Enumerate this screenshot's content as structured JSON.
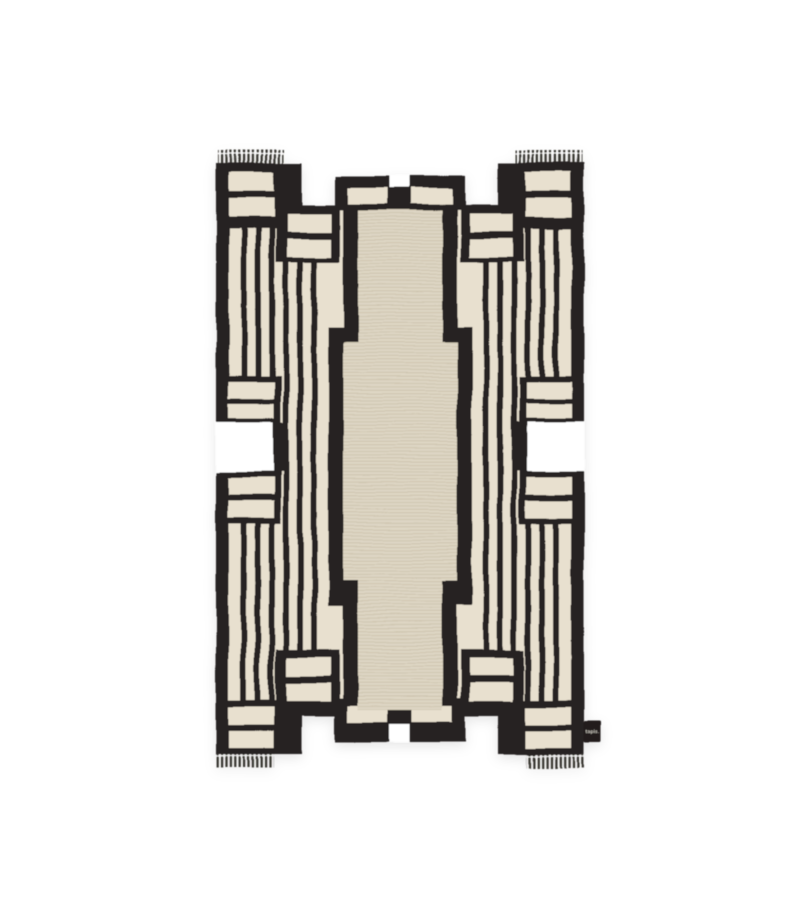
{
  "meta": {
    "description": "Product photograph of a hand-knotted black and cream art-deco geometric rug with stepped silhouette and fringed ends, centered on a plain white background",
    "alt": "Black and cream geometric art deco rug with fringe"
  },
  "colors": {
    "background": "#ffffff",
    "black": "#282320",
    "cream": "#e8e0cf",
    "field": "#ded6c4",
    "field_line": "#c3b8a1",
    "fringe": "#33302c",
    "tag": "#221f1c",
    "tag_text": "#f4f0e6",
    "shadow_opacity": "0.10"
  },
  "tag": {
    "label": "tapis."
  }
}
